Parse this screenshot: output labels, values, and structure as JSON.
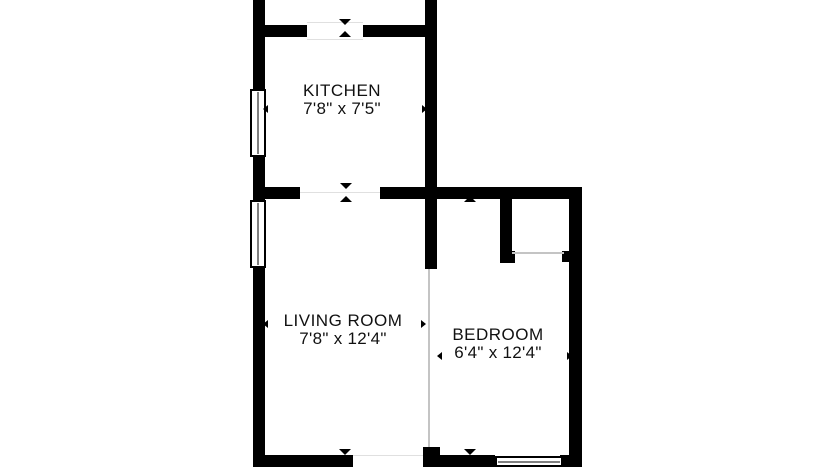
{
  "floor_plan": {
    "rooms": [
      {
        "name": "KITCHEN",
        "dimensions": "7'8\" x 7'5\""
      },
      {
        "name": "LIVING ROOM",
        "dimensions": "7'8\" x 12'4\""
      },
      {
        "name": "BEDROOM",
        "dimensions": "6'4\" x 12'4\""
      }
    ],
    "colors": {
      "wall": "#000000",
      "background": "#ffffff",
      "opening_line": "#e0e0e0",
      "divider_line": "#c4c4c4",
      "text": "#111111"
    }
  }
}
